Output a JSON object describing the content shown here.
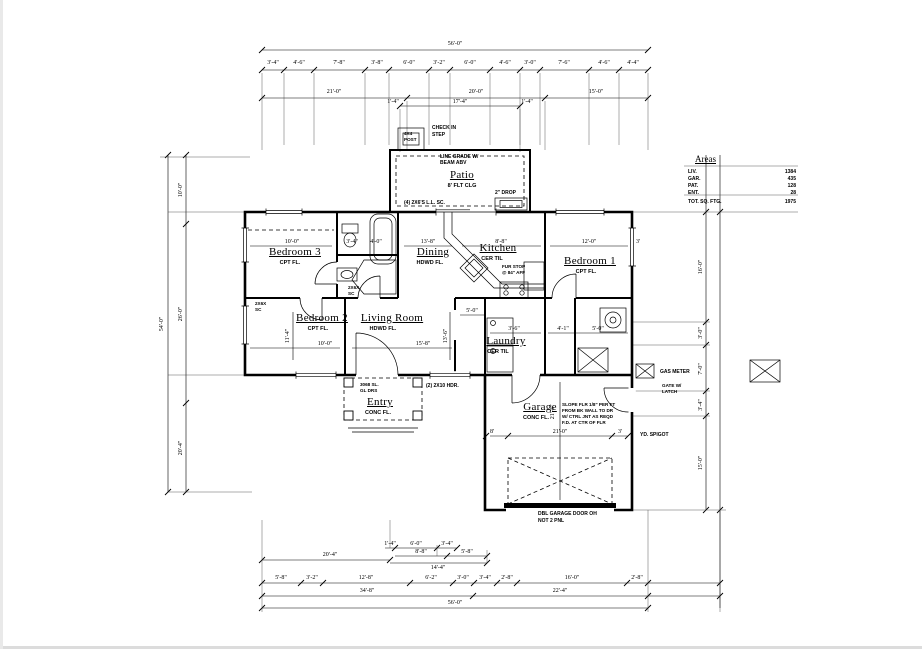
{
  "dims": {
    "top_overall": "56'-0\"",
    "top_segments": [
      "3'-4\"",
      "4'-6\"",
      "7'-8\"",
      "3'-8\"",
      "6'-0\"",
      "3'-2\"",
      "6'-0\"",
      "4'-6\"",
      "3'-0\"",
      "7'-6\"",
      "4'-6\"",
      "4'-4\""
    ],
    "top_row2": [
      "21'-0\"",
      "20'-0\"",
      "15'-0\""
    ],
    "patio_row": [
      "1'-4\"",
      "17'-4\"",
      "1'-4\""
    ],
    "left": [
      "54'-0\"",
      "10'-0\"",
      "26'-0\"",
      "20'-4\""
    ],
    "right": [
      "16'-0\"",
      "3'-0\"",
      "7'-0\"",
      "3'-4\"",
      "15'-0\""
    ],
    "interior": {
      "bed3_w": "10'-0\"",
      "bed3_a": "3'-4\"",
      "bed3_b": "4'-0\"",
      "dining_w": "13'-8\"",
      "kitchen_w": "8'-8\"",
      "bed1_w": "12'-0\"",
      "bed1_side": "3'",
      "bed2_w": "10'-0\"",
      "bed2_h": "11'-4\"",
      "living_w": "15'-8\"",
      "living_h": "13'-6\"",
      "hall": "5'-0\"",
      "laundry_a": "3'-6\"",
      "laundry_b": "4'-1\"",
      "laundry_c": "5'-0\"",
      "garage_l": "8'",
      "garage_w": "21'-0\"",
      "garage_r": "3'",
      "garage_h": "21'-4\""
    },
    "bottom_cluster": {
      "a": "20'-4\"",
      "b": "1'-4\"",
      "c": "6'-0\"",
      "d": "3'-4\"",
      "e": "8'-8\"",
      "f": "14'-4\"",
      "g": "5'-8\""
    },
    "bottom_row1": [
      "5'-8\"",
      "3'-2\"",
      "12'-8\"",
      "6'-2\"",
      "3'-0\"",
      "3'-4\"",
      "2'-8\"",
      "16'-0\"",
      "2'-8\""
    ],
    "bottom_row2": [
      "34'-8\"",
      "22'-4\""
    ],
    "bottom_total": "56'-0\""
  },
  "rooms": {
    "patio": {
      "name": "Patio",
      "sub": "8' FLT CLG"
    },
    "bedroom3": {
      "name": "Bedroom 3",
      "sub": "CPT FL."
    },
    "bedroom2": {
      "name": "Bedroom 2",
      "sub": "CPT FL."
    },
    "living": {
      "name": "Living Room",
      "sub": "HDWD FL."
    },
    "dining": {
      "name": "Dining",
      "sub": "HDWD FL."
    },
    "kitchen": {
      "name": "Kitchen",
      "sub": "CER TIL"
    },
    "bedroom1": {
      "name": "Bedroom 1",
      "sub": "CPT FL."
    },
    "laundry": {
      "name": "Laundry",
      "sub": "CER TIL"
    },
    "entry": {
      "name": "Entry",
      "sub": "CONC FL."
    },
    "garage": {
      "name": "Garage",
      "sub": "CONC FL."
    }
  },
  "notes": {
    "step": [
      "CHECK IN",
      "STEP"
    ],
    "post": [
      "4X4",
      "POST"
    ],
    "patio_beam": [
      "LINE GRADE W/",
      "BEAM ABV"
    ],
    "patio_post": "(4) 2X6'S L.L. SC.",
    "patio_drop": "2\" DROP",
    "entry_door": [
      "3068 SL.",
      "GL DRS"
    ],
    "entry_hdr": "(2) 2X10 HDR.",
    "kitchen_fur": [
      "FUR STOP",
      "@ 84\" AFF"
    ],
    "tag1": [
      "2X6X",
      "SC"
    ],
    "tag2": [
      "2X6X",
      "SC"
    ],
    "garage_slope": [
      "SLOPE FLR 1/8\" PER FT",
      "FROM BK WALL TO DR",
      "W/ CTRL JNT AS REQD",
      "F.D. AT CTR OF FLR"
    ],
    "garage_door": [
      "DBL GARAGE DOOR OH",
      "NOT 2 PNL"
    ],
    "gas_meter": "GAS METER",
    "gate": [
      "GATE W/",
      "LATCH"
    ],
    "spigot": "YD. SPIGOT"
  },
  "areas": {
    "title": "Areas",
    "rows": [
      {
        "label": "LIV.",
        "value": "1384"
      },
      {
        "label": "GAR.",
        "value": "435"
      },
      {
        "label": "PAT.",
        "value": "128"
      },
      {
        "label": "ENT.",
        "value": "28"
      }
    ],
    "total_label": "TOT. SQ. FTG.",
    "total_value": "1975"
  }
}
